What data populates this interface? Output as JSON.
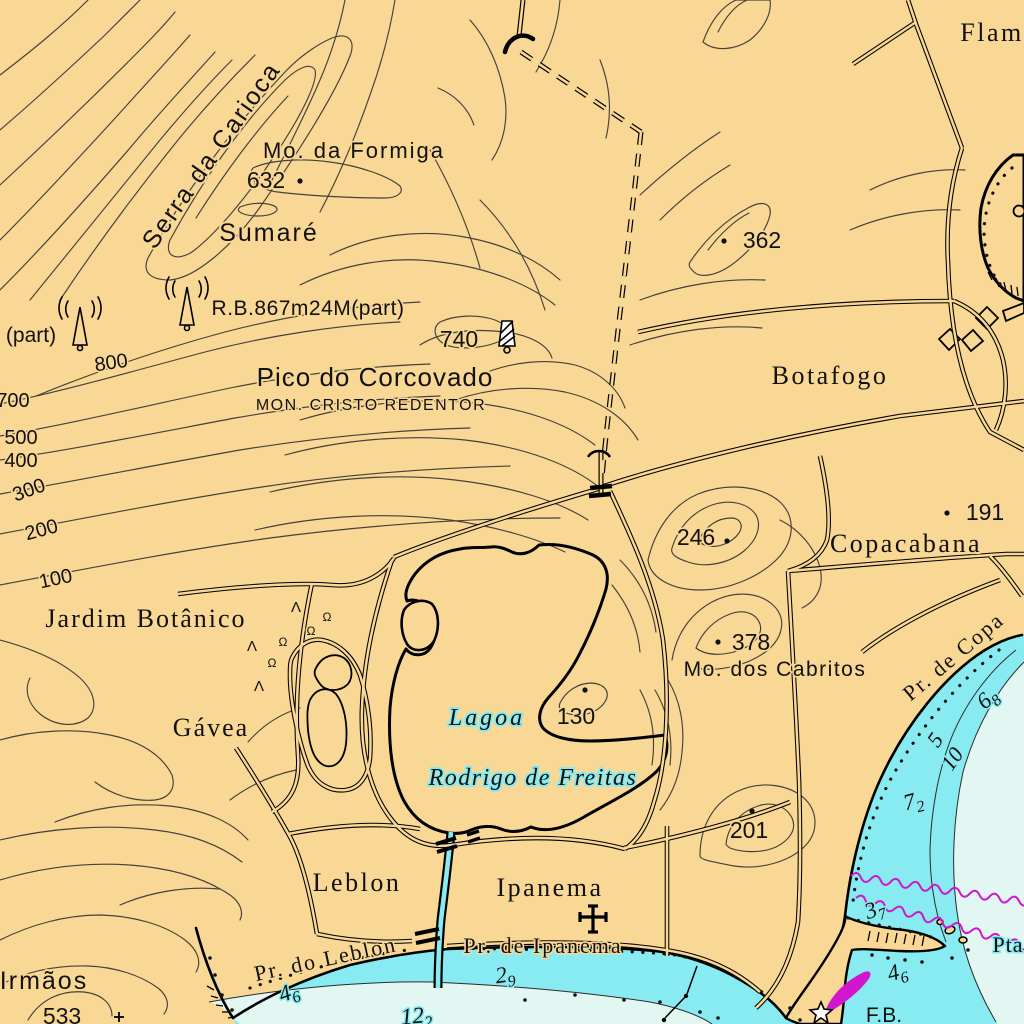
{
  "colors": {
    "land": "#F9D795",
    "water_shallow": "#87EBF1",
    "water_deep": "#E2F7F2",
    "contour": "#46413a",
    "ink": "#111111",
    "magenta": "#D216CE"
  },
  "map": {
    "place_labels": [
      {
        "name": "label-serra-da-carioca",
        "text": "Serra da Carioca",
        "x": 218,
        "y": 160,
        "size": 25,
        "font": "sans",
        "rotate": -55,
        "spacing": 2,
        "halo": "land"
      },
      {
        "name": "label-mo-da-formiga",
        "text": "Mo. da Formiga",
        "x": 354,
        "y": 158,
        "size": 22,
        "font": "sans",
        "spacing": 2,
        "halo": "land"
      },
      {
        "name": "label-sumare",
        "text": "Sumaré",
        "x": 269,
        "y": 241,
        "size": 25,
        "font": "sans",
        "spacing": 2,
        "halo": "land"
      },
      {
        "name": "label-part",
        "text": "(part)",
        "x": 31,
        "y": 342,
        "size": 21,
        "font": "sans",
        "halo": "land"
      },
      {
        "name": "label-radio-station",
        "text": "R.B.867m24M(part)",
        "x": 308,
        "y": 315,
        "size": 21,
        "font": "sans",
        "spacing": 0.5,
        "halo": "land"
      },
      {
        "name": "label-pico-do-corcovado",
        "text": "Pico do Corcovado",
        "x": 375,
        "y": 386,
        "size": 26,
        "font": "sans",
        "spacing": 1,
        "halo": "land"
      },
      {
        "name": "label-mon-cristo-redentor",
        "text": "MON. CRISTO REDENTOR",
        "x": 371,
        "y": 410,
        "size": 16,
        "font": "sans",
        "spacing": 1.5,
        "halo": "land"
      },
      {
        "name": "label-flamengo",
        "text": "Flam",
        "x": 992,
        "y": 41,
        "size": 26,
        "font": "serif",
        "spacing": 2.5,
        "halo": "land"
      },
      {
        "name": "label-botafogo",
        "text": "Botafogo",
        "x": 830,
        "y": 384,
        "size": 26,
        "font": "serif",
        "spacing": 2.5,
        "halo": "land"
      },
      {
        "name": "label-copacabana",
        "text": "Copacabana",
        "x": 906,
        "y": 552,
        "size": 26,
        "font": "serif",
        "spacing": 2.5,
        "halo": "land"
      },
      {
        "name": "label-mo-dos-cabritos",
        "text": "Mo. dos Cabritos",
        "x": 775,
        "y": 676,
        "size": 21,
        "font": "sans",
        "spacing": 1.5,
        "halo": "land"
      },
      {
        "name": "label-jardim-botanico",
        "text": "Jardim Botânico",
        "x": 146,
        "y": 627,
        "size": 26,
        "font": "serif",
        "spacing": 2,
        "halo": "land"
      },
      {
        "name": "label-gavea",
        "text": "Gávea",
        "x": 211,
        "y": 736,
        "size": 26,
        "font": "serif",
        "spacing": 2,
        "halo": "land"
      },
      {
        "name": "label-lagoa",
        "text": "Lagoa",
        "x": 487,
        "y": 725,
        "size": 24,
        "font": "serif",
        "italic": true,
        "spacing": 3,
        "halo": "water"
      },
      {
        "name": "label-rodrigo-de-freitas",
        "text": "Rodrigo de Freitas",
        "x": 533,
        "y": 785,
        "size": 24,
        "font": "serif",
        "italic": true,
        "spacing": 1.5,
        "halo": "water"
      },
      {
        "name": "label-leblon",
        "text": "Leblon",
        "x": 357,
        "y": 891,
        "size": 26,
        "font": "serif",
        "spacing": 2.5,
        "halo": "land"
      },
      {
        "name": "label-ipanema",
        "text": "Ipanema",
        "x": 550,
        "y": 896,
        "size": 26,
        "font": "serif",
        "spacing": 2.5,
        "halo": "land"
      },
      {
        "name": "label-pr-do-leblon",
        "text": "Pr. do Leblon",
        "x": 327,
        "y": 966,
        "size": 22,
        "font": "serif",
        "rotate": -12,
        "spacing": 2,
        "halo": "land"
      },
      {
        "name": "label-pr-de-ipanema",
        "text": "Pr. de Ipanema",
        "x": 543,
        "y": 953,
        "size": 22,
        "font": "serif",
        "spacing": 2,
        "halo": "land"
      },
      {
        "name": "label-pr-de-copacabana",
        "text": "Pr. de Copa",
        "x": 958,
        "y": 662,
        "size": 22,
        "font": "serif",
        "rotate": -40,
        "spacing": 2,
        "halo": "land"
      },
      {
        "name": "label-pta",
        "text": "Pta",
        "x": 1008,
        "y": 952,
        "size": 22,
        "font": "serif",
        "spacing": 1,
        "halo": "water"
      },
      {
        "name": "label-irmaos",
        "text": "Irmãos",
        "x": 44,
        "y": 989,
        "size": 25,
        "font": "sans",
        "spacing": 2,
        "halo": "land"
      },
      {
        "name": "label-light-fb",
        "text": "F.B.",
        "x": 884,
        "y": 1022,
        "size": 21,
        "font": "sans",
        "halo": "water"
      }
    ],
    "contour_labels": [
      {
        "name": "contour-label-800",
        "text": "800",
        "x": 112,
        "y": 369,
        "rotate": -8
      },
      {
        "name": "contour-label-700",
        "text": "700",
        "x": 13,
        "y": 407
      },
      {
        "name": "contour-label-500",
        "text": "500",
        "x": 21,
        "y": 444
      },
      {
        "name": "contour-label-400",
        "text": "400",
        "x": 21,
        "y": 467
      },
      {
        "name": "contour-label-300",
        "text": "300",
        "x": 31,
        "y": 496,
        "rotate": -20
      },
      {
        "name": "contour-label-200",
        "text": "200",
        "x": 43,
        "y": 536,
        "rotate": -15
      },
      {
        "name": "contour-label-100",
        "text": "100",
        "x": 57,
        "y": 585,
        "rotate": -12
      }
    ],
    "spot_heights": [
      {
        "v": "632",
        "tx": 266,
        "ty": 188,
        "dx": 300,
        "dy": 181
      },
      {
        "v": "740",
        "tx": 459,
        "ty": 347
      },
      {
        "v": "362",
        "tx": 762,
        "ty": 248,
        "dx": 724,
        "dy": 241
      },
      {
        "v": "246",
        "tx": 696,
        "ty": 545,
        "dx": 727,
        "dy": 541
      },
      {
        "v": "191",
        "tx": 985,
        "ty": 520,
        "dx": 947,
        "dy": 513
      },
      {
        "v": "378",
        "tx": 751,
        "ty": 650,
        "dx": 718,
        "dy": 642
      },
      {
        "v": "130",
        "tx": 576,
        "ty": 724,
        "dx": 585,
        "dy": 690
      },
      {
        "v": "201",
        "tx": 749,
        "ty": 838,
        "dx": 752,
        "dy": 811
      },
      {
        "v": "533",
        "tx": 62,
        "ty": 1024
      }
    ],
    "soundings": [
      {
        "main": "4",
        "sub": "6",
        "x": 291,
        "y": 999,
        "rotate": -20
      },
      {
        "main": "2",
        "sub": "9",
        "x": 506,
        "y": 982,
        "rotate": -8
      },
      {
        "main": "12",
        "sub": "2",
        "x": 417,
        "y": 1023,
        "rotate": -5
      },
      {
        "main": "3",
        "sub": "7",
        "x": 877,
        "y": 916,
        "rotate": -20
      },
      {
        "main": "4",
        "sub": "6",
        "x": 899,
        "y": 979,
        "rotate": -15
      },
      {
        "main": "7",
        "sub": "2",
        "x": 915,
        "y": 808,
        "rotate": -15
      },
      {
        "main": "6",
        "sub": "8",
        "x": 992,
        "y": 704,
        "rotate": -40
      }
    ],
    "depth_contour_labels": [
      {
        "text": "5",
        "x": 941,
        "y": 744,
        "rotate": -55
      },
      {
        "text": "10",
        "x": 958,
        "y": 763,
        "rotate": -55
      }
    ],
    "veg_symbols": [
      {
        "glyph": "Λ",
        "x": 296,
        "y": 612
      },
      {
        "glyph": "Ω",
        "x": 327,
        "y": 621
      },
      {
        "glyph": "Ω",
        "x": 311,
        "y": 635
      },
      {
        "glyph": "Λ",
        "x": 252,
        "y": 651
      },
      {
        "glyph": "Ω",
        "x": 283,
        "y": 646
      },
      {
        "glyph": "Ω",
        "x": 272,
        "y": 667
      },
      {
        "glyph": "Λ",
        "x": 259,
        "y": 691
      }
    ],
    "cables": [
      {
        "x1": 851,
        "y1": 876,
        "x2": 1025,
        "y2": 902
      },
      {
        "x1": 856,
        "y1": 898,
        "x2": 1025,
        "y2": 946
      }
    ]
  }
}
